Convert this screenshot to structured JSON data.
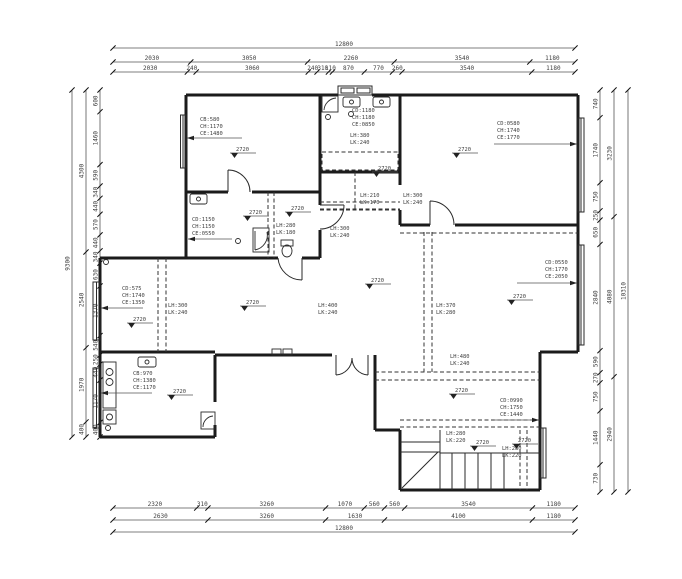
{
  "drawing": {
    "type": "residential floor plan",
    "elevation": {
      "value": "2720"
    }
  },
  "dims": {
    "top_row1": [
      "12800"
    ],
    "top_row2": [
      "2030",
      "3050",
      "2260",
      "3540",
      "1180"
    ],
    "top_row3": [
      "2030",
      "240",
      "3060",
      "240",
      "310",
      "110",
      "870",
      "770",
      "260",
      "3540",
      "1180"
    ],
    "bottom_row1": [
      "2320",
      "310",
      "3260",
      "1070",
      "560",
      "560",
      "3540",
      "1180"
    ],
    "bottom_row2": [
      "2630",
      "3260",
      "1630",
      "4100",
      "1180"
    ],
    "bottom_row3": [
      "12800"
    ],
    "left_inner": [
      "600",
      "1460",
      "590",
      "340",
      "440",
      "570",
      "440",
      "340",
      "630",
      "1370",
      "540",
      "250",
      "440",
      "1170",
      "400"
    ],
    "left_middle": [
      "4300",
      "2540",
      "1970",
      "400"
    ],
    "left_outer": [
      "9300"
    ],
    "right_inner": [
      "740",
      "1740",
      "750",
      "250",
      "650",
      "2840",
      "590",
      "270",
      "750",
      "1440",
      "730"
    ],
    "right_middle": [
      "3230",
      "4080",
      "2940"
    ],
    "right_outer": [
      "10310"
    ]
  },
  "windows": [
    {
      "l1": "CB:580",
      "l2": "CH:1170",
      "l3": "CE:1480"
    },
    {
      "l1": "CD:1180",
      "l2": "CH:1180",
      "l3": "CE:0850"
    },
    {
      "l1": "CD:0580",
      "l2": "CH:1740",
      "l3": "CE:1770"
    },
    {
      "l1": "CD:1150",
      "l2": "CH:1150",
      "l3": "CE:0550"
    },
    {
      "l1": "CD:575",
      "l2": "CH:1740",
      "l3": "CE:1350"
    },
    {
      "l1": "CD:0550",
      "l2": "CH:1770",
      "l3": "CE:2050"
    },
    {
      "l1": "CB:970",
      "l2": "CH:1380",
      "l3": "CE:1170"
    },
    {
      "l1": "CD:0990",
      "l2": "CH:1750",
      "l3": "CE:1440"
    }
  ],
  "beams": [
    {
      "h": "LH:380",
      "k": "LK:240"
    },
    {
      "h": "LH:210",
      "k": "LK:170"
    },
    {
      "h": "LH:300",
      "k": "LK:240"
    },
    {
      "h": "LH:280",
      "k": "LK:180"
    },
    {
      "h": "LH:300",
      "k": "LK:240"
    },
    {
      "h": "LH:300",
      "k": "LK:240"
    },
    {
      "h": "LH:400",
      "k": "LK:240"
    },
    {
      "h": "LH:370",
      "k": "LK:280"
    },
    {
      "h": "LH:480",
      "k": "LK:240"
    },
    {
      "h": "LH:280",
      "k": "LK:220"
    },
    {
      "h": "LH:280",
      "k": "LK:220"
    }
  ]
}
